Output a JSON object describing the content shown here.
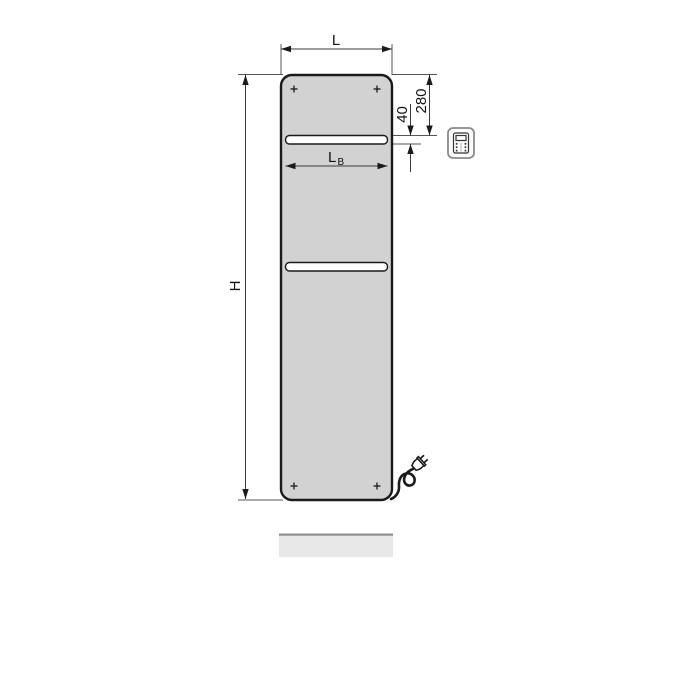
{
  "drawing": {
    "dimensions": {
      "width_label": "L",
      "height_label": "H",
      "bar_width_label_main": "L",
      "bar_width_label_sub": "B",
      "top_offset_value": "280",
      "slot_height_value": "40"
    },
    "icons": {
      "control_unit": "electric-control-unit-icon",
      "plug": "power-plug-icon"
    },
    "colors": {
      "background": "#ffffff",
      "panel_fill": "#d2d2d2",
      "panel_outline": "#1a1a1a",
      "dimension_lines": "#3a3a3a",
      "reflection_fill": "#e7e7e7",
      "reflection_edge": "#8f8f8f"
    }
  }
}
